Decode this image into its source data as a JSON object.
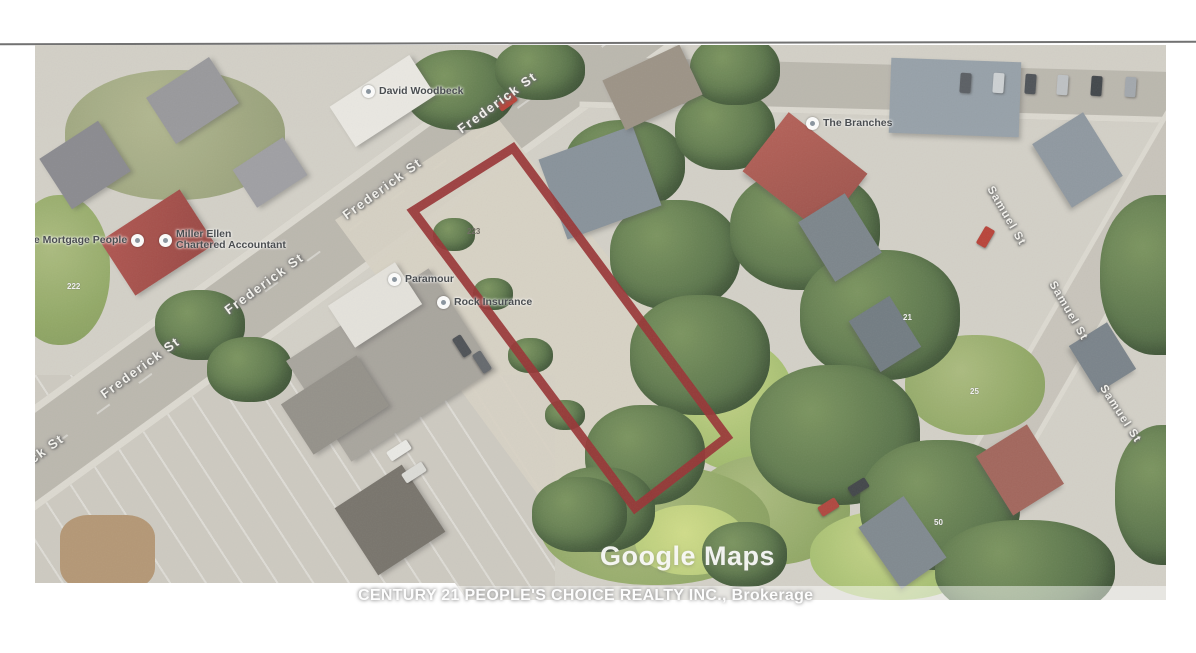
{
  "page": {
    "watermark": "Google Maps",
    "brokerage_line": "CENTURY 21 PEOPLE'S CHOICE REALTY INC., Brokerage"
  },
  "streets": {
    "frederick": "Frederick St",
    "frederick_partial": "ck St",
    "samuel": "Samuel St"
  },
  "pois": {
    "david_woodbeck": "David Woodbeck",
    "mortgage_people": "The Mortgage People",
    "miller_ellen_line1": "Miller Ellen",
    "miller_ellen_line2": "Chartered Accountant",
    "paramour": "Paramour",
    "rock_insurance": "Rock Insurance",
    "branches": "The Branches"
  },
  "house_numbers": {
    "subject_lot": "223",
    "n222": "222",
    "n21": "21",
    "n25": "25",
    "n50": "50"
  },
  "colors": {
    "outline": "#8e2022",
    "gravel": "#d4cec0"
  }
}
